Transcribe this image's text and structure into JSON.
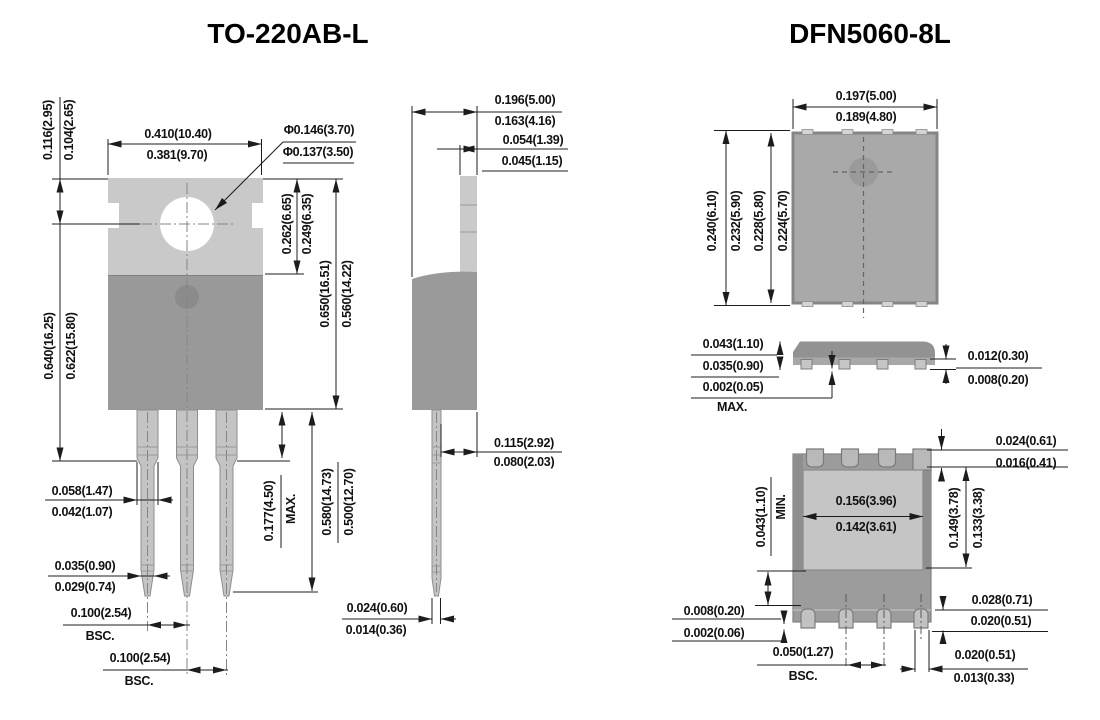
{
  "titles": {
    "to220": "TO-220AB-L",
    "dfn": "DFN5060-8L"
  },
  "to220": {
    "front": {
      "tab_width_max": "0.410(10.40)",
      "tab_width_min": "0.381(9.70)",
      "hole_dia_max": "Φ0.146(3.70)",
      "hole_dia_min": "Φ0.137(3.50)",
      "hole_offset_max": "0.116(2.95)",
      "hole_offset_min": "0.104(2.65)",
      "length_max": "0.640(16.25)",
      "length_min": "0.622(15.80)",
      "tab_height_max": "0.262(6.65)",
      "tab_height_min": "0.249(6.35)",
      "body_height_max": "0.650(16.51)",
      "body_height_min": "0.560(14.22)",
      "shoulder_len": "0.177(4.50)",
      "shoulder_suffix": "MAX.",
      "lead_len_max": "0.580(14.73)",
      "lead_len_min": "0.500(12.70)",
      "lead_width_max": "0.058(1.47)",
      "lead_width_min": "0.042(1.07)",
      "lead_tip_width_max": "0.035(0.90)",
      "lead_tip_width_min": "0.029(0.74)",
      "pitch1": "0.100(2.54)",
      "pitch1_suffix": "BSC.",
      "pitch2": "0.100(2.54)",
      "pitch2_suffix": "BSC."
    },
    "side": {
      "depth_max": "0.196(5.00)",
      "depth_min": "0.163(4.16)",
      "tab_thickness_max": "0.054(1.39)",
      "tab_thickness_min": "0.045(1.15)",
      "lead_offset_max": "0.115(2.92)",
      "lead_offset_min": "0.080(2.03)",
      "lead_thickness_max": "0.024(0.60)",
      "lead_thickness_min": "0.014(0.36)"
    }
  },
  "dfn": {
    "top": {
      "width_max": "0.197(5.00)",
      "width_min": "0.189(4.80)",
      "length1": "0.240(6.10)",
      "length2": "0.232(5.90)",
      "length3": "0.228(5.80)",
      "length4": "0.224(5.70)"
    },
    "side": {
      "height_max": "0.043(1.10)",
      "height_min": "0.035(0.90)",
      "standoff": "0.002(0.05)",
      "standoff_suffix": "MAX.",
      "lead_thickness_max": "0.012(0.30)",
      "lead_thickness_min": "0.008(0.20)"
    },
    "bottom": {
      "pad_clearance": "0.043(1.10)",
      "pad_clearance_suffix": "MIN.",
      "pad_width_max": "0.156(3.96)",
      "pad_width_min": "0.142(3.61)",
      "pad_height_max": "0.149(3.78)",
      "pad_height_min": "0.133(3.38)",
      "corner_pad_max": "0.024(0.61)",
      "corner_pad_min": "0.016(0.41)",
      "lead_len_max": "0.028(0.71)",
      "lead_len_min": "0.020(0.51)",
      "lead_protrusion_max": "0.008(0.20)",
      "lead_protrusion_min": "0.002(0.06)",
      "pitch": "0.050(1.27)",
      "pitch_suffix": "BSC.",
      "lead_width_max": "0.020(0.51)",
      "lead_width_min": "0.013(0.33)"
    }
  },
  "colors": {
    "tab_gray": "#c9c9c9",
    "body_gray": "#999999",
    "lead_gray": "#c4c4c4",
    "dfn_body": "#a9a9a9",
    "exposed_pad": "#c5c5c5",
    "line": "#1c1c1c"
  }
}
